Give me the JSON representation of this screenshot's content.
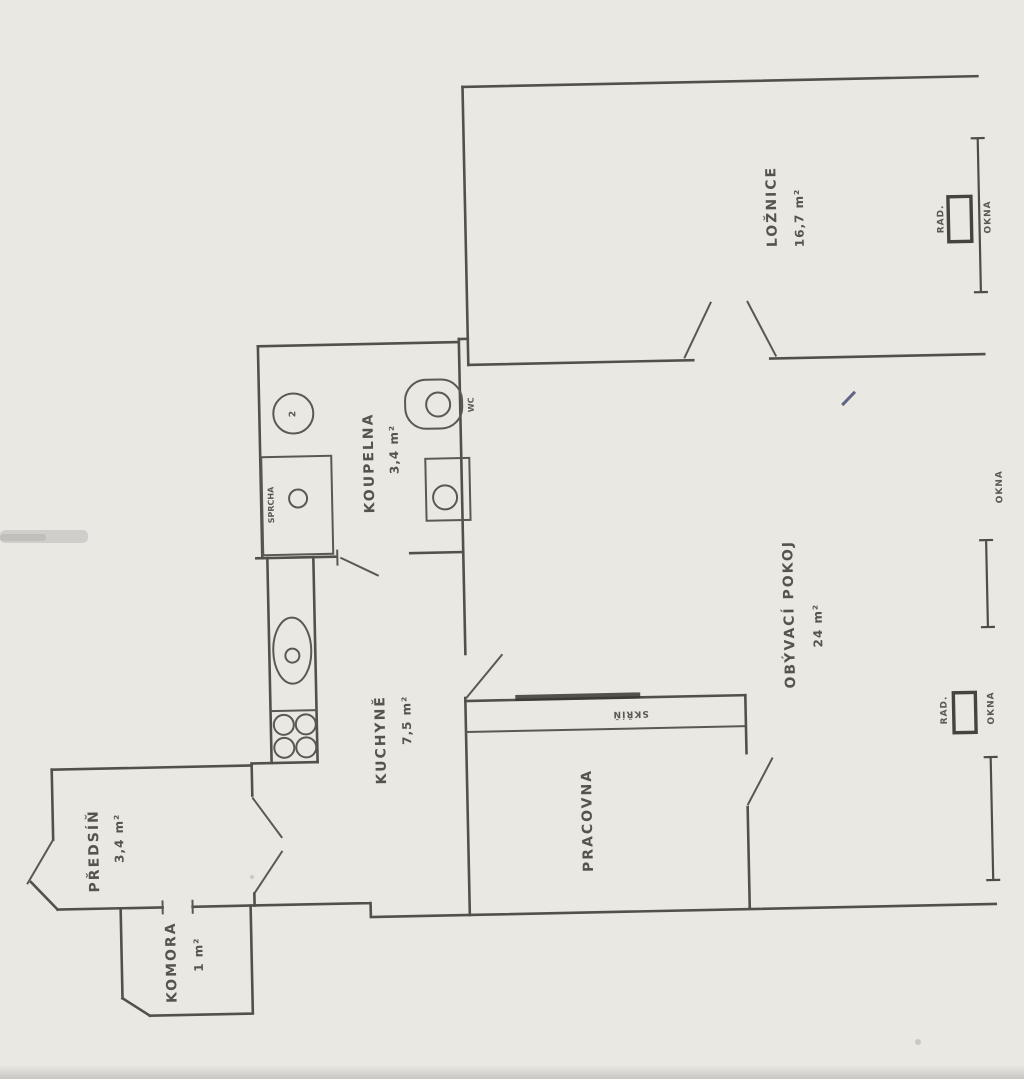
{
  "document": {
    "type": "scanned-floor-plan",
    "paper_color": "#eae8e3",
    "ink_color": "#52504b"
  },
  "rooms": {
    "loznice": {
      "name": "LOŽNICE",
      "area": "16,7 m²"
    },
    "obyvaci": {
      "name": "OBÝVACÍ POKOJ",
      "area": "24 m²"
    },
    "kuchyne": {
      "name": "KUCHYNĚ",
      "area": "7,5 m²"
    },
    "koupelna": {
      "name": "KOUPELNA",
      "area": "3,4 m²"
    },
    "predsin": {
      "name": "PŘEDSÍŇ",
      "area": "3,4 m²"
    },
    "komora": {
      "name": "KOMORA",
      "area": "1 m²"
    },
    "pracovna": {
      "name": "PRACOVNA"
    }
  },
  "labels": {
    "window": "OKNA",
    "radiator": "RAD.",
    "wardrobe": "SKŘÍŇ",
    "wc": "WC",
    "shower": "SPRCHA",
    "appliance_mark": "2"
  }
}
